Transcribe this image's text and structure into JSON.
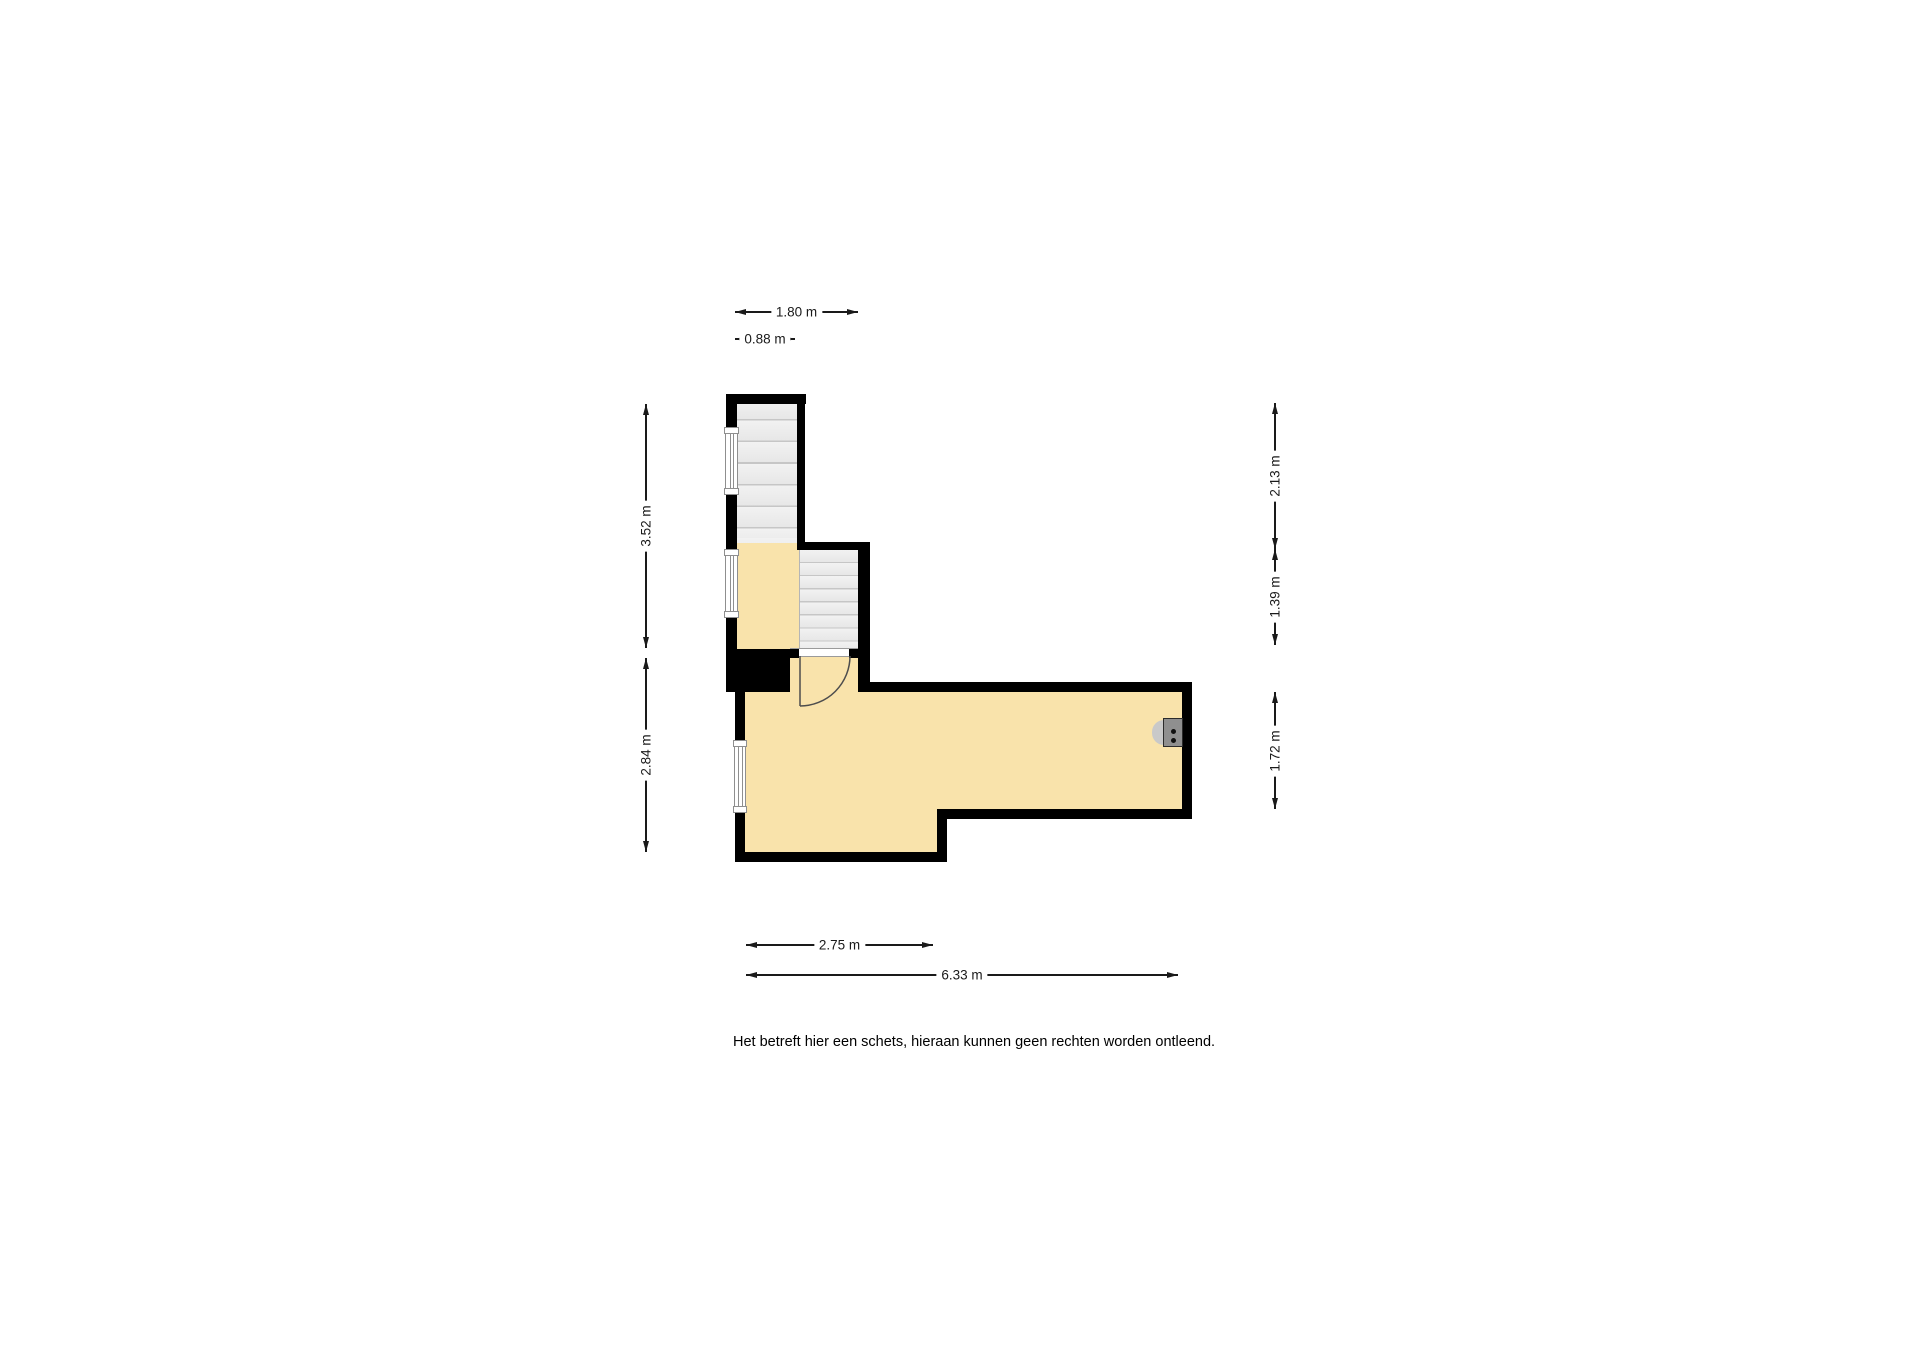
{
  "colors": {
    "bg": "#ffffff",
    "wall": "#000000",
    "floor": "#f9e3ab",
    "stair_fill_a": "#f2f2f2",
    "stair_fill_b": "#e7e7e7",
    "stair_line": "#c6c6c6",
    "window_line": "#8f8f8f",
    "dim_color": "#1a1a1a",
    "door_line": "#4d4d4d",
    "boiler_body": "#8f8f8f",
    "boiler_tab": "#c9c9c9",
    "text": "#000000"
  },
  "floorplan": {
    "type": "floor-plan-sketch",
    "dimensions": {
      "top_width": "1.80 m",
      "stair_width": "0.88 m",
      "left_upper_height": "3.52 m",
      "left_lower_height": "2.84 m",
      "right_upper_height": "2.13 m",
      "right_middle_height": "1.39 m",
      "right_lower_height": "1.72 m",
      "bottom_inner_width": "2.75 m",
      "bottom_total_width": "6.33 m"
    },
    "icons": {
      "staircase_main": "staircase-icon (css tread stripes)",
      "staircase_attic": "staircase-icon (css tread stripes)",
      "window": "window-icon (white strip with panes)",
      "door_swing": "door-swing-icon (svg quarter arc)",
      "boiler": "boiler-icon (gray box with two dots)"
    },
    "disclaimer": "Het betreft hier een schets, hieraan kunnen geen rechten worden ontleend."
  }
}
